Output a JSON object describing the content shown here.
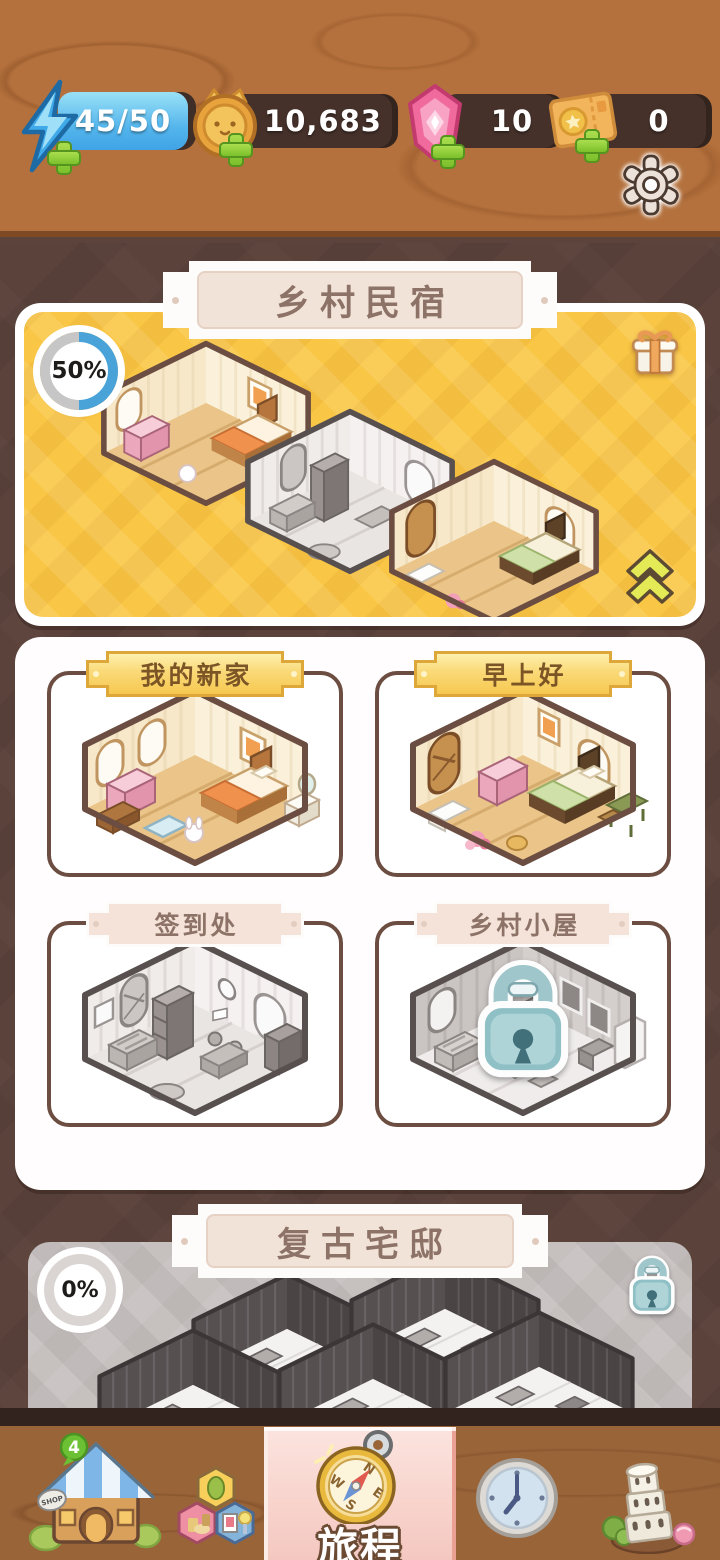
{
  "currency_bar": {
    "energy": {
      "value": "45/50",
      "icon": "lightning-bolt"
    },
    "coins": {
      "value": "10,683",
      "icon": "cat-coin"
    },
    "gems": {
      "value": "10",
      "icon": "pink-gem"
    },
    "tickets": {
      "value": "0",
      "icon": "ticket"
    }
  },
  "chapters": {
    "current": {
      "title": "乡村民宿",
      "progress": "50%"
    },
    "next": {
      "title": "复古宅邸",
      "progress": "0%",
      "locked": true
    }
  },
  "rooms": [
    {
      "name": "我的新家",
      "variant": "gold",
      "locked": false
    },
    {
      "name": "早上好",
      "variant": "gold",
      "locked": false
    },
    {
      "name": "签到处",
      "variant": "rose",
      "locked": false
    },
    {
      "name": "乡村小屋",
      "variant": "rose",
      "locked": true
    }
  ],
  "nav": {
    "shop_badge": "4",
    "selected_label": "旅程",
    "items": [
      "shop",
      "collection",
      "journey",
      "time",
      "landmarks"
    ]
  },
  "icons": {
    "settings": "gear",
    "reward": "gift-box",
    "collapse": "double-chevron-up",
    "locked": "padlock",
    "shop": "shop-house",
    "collection": "furniture-hexagons",
    "journey": "compass",
    "time": "clock",
    "landmarks": "leaning-tower"
  },
  "colors": {
    "chapter_card_yellow": "#f9c645",
    "selected_tab_pink": "#f8d4cd",
    "wood_top": "#b4713d",
    "background_brown": "#5b423b",
    "nav_wood": "#9a6439",
    "progress_blue": "#4aa3d8",
    "banner_text": "#8d7367",
    "card_border": "#6b4d41"
  }
}
